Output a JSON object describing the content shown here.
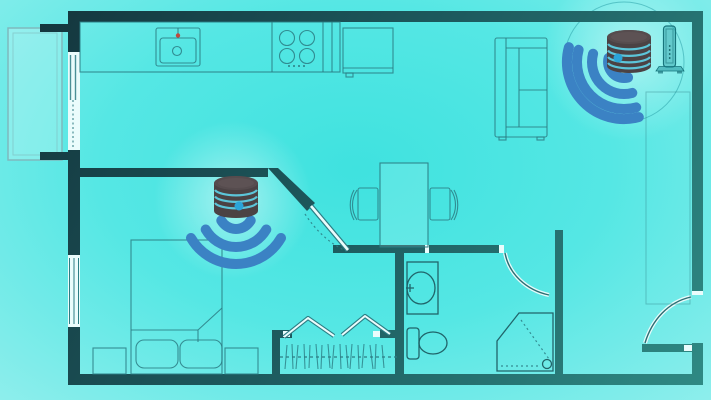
{
  "scene": {
    "type": "floor-plan-illustration",
    "subject": "apartment-with-mesh-wifi-coverage",
    "devices": [
      {
        "name": "wifi-router-bedroom",
        "style": "stacked-disc-speaker",
        "signal_arcs": 3,
        "led_dot": true
      },
      {
        "name": "wifi-router-living",
        "style": "stacked-disc-speaker",
        "signal_arcs": 4,
        "led_dot": true,
        "range_ring": true
      }
    ],
    "rooms": [
      "kitchen",
      "living-dining",
      "bedroom",
      "bathroom",
      "closet",
      "hallway",
      "balcony"
    ],
    "furniture": [
      "kitchen-counter",
      "sink",
      "stove",
      "fridge",
      "sofa",
      "dining-table",
      "chair",
      "chair",
      "bed",
      "pillow",
      "pillow",
      "nightstand",
      "nightstand",
      "wardrobe-rail",
      "washbasin",
      "toilet",
      "corner-shower",
      "radiator"
    ]
  },
  "palette": {
    "background_center": "#49e5e2",
    "background_edge": "#f0fdfd",
    "wall_dark": "#13323a",
    "wall_mid": "#1d5a5e",
    "wall_light": "#2f8b85",
    "outline_teal": "#2c7d84",
    "fixture_teal": "#1e5d63",
    "wifi_blue": "#3b82c4",
    "device_body": "#4b4244",
    "device_top": "#564c4e",
    "device_ring_gap": "#5cc5d9",
    "led_blue": "#2ba4d8",
    "range_ring": "#2aa0a8",
    "faucet_red": "#bf4a3e",
    "door_white": "#eafcfc"
  }
}
